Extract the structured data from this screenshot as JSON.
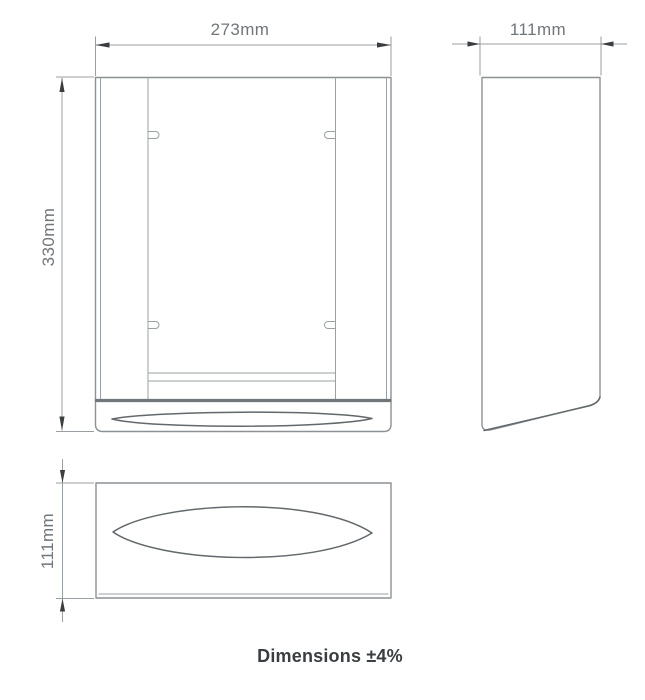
{
  "drawing": {
    "type": "technical-dimension-drawing",
    "views": {
      "front": {
        "width_label": "273mm",
        "height_label": "330mm"
      },
      "side": {
        "depth_label": "111mm"
      },
      "plan": {
        "depth_label": "111mm"
      }
    },
    "note": "Dimensions ±4%",
    "colors": {
      "background": "#ffffff",
      "outline": "#8b9194",
      "interior_line": "#9aa0a3",
      "accent_dark": "#62686b",
      "tray_band": "#70767a",
      "dimension_line": "#989ea1",
      "arrowhead": "#3a3e40",
      "dimension_text": "#70767a",
      "note_text": "#3a3e41"
    }
  }
}
